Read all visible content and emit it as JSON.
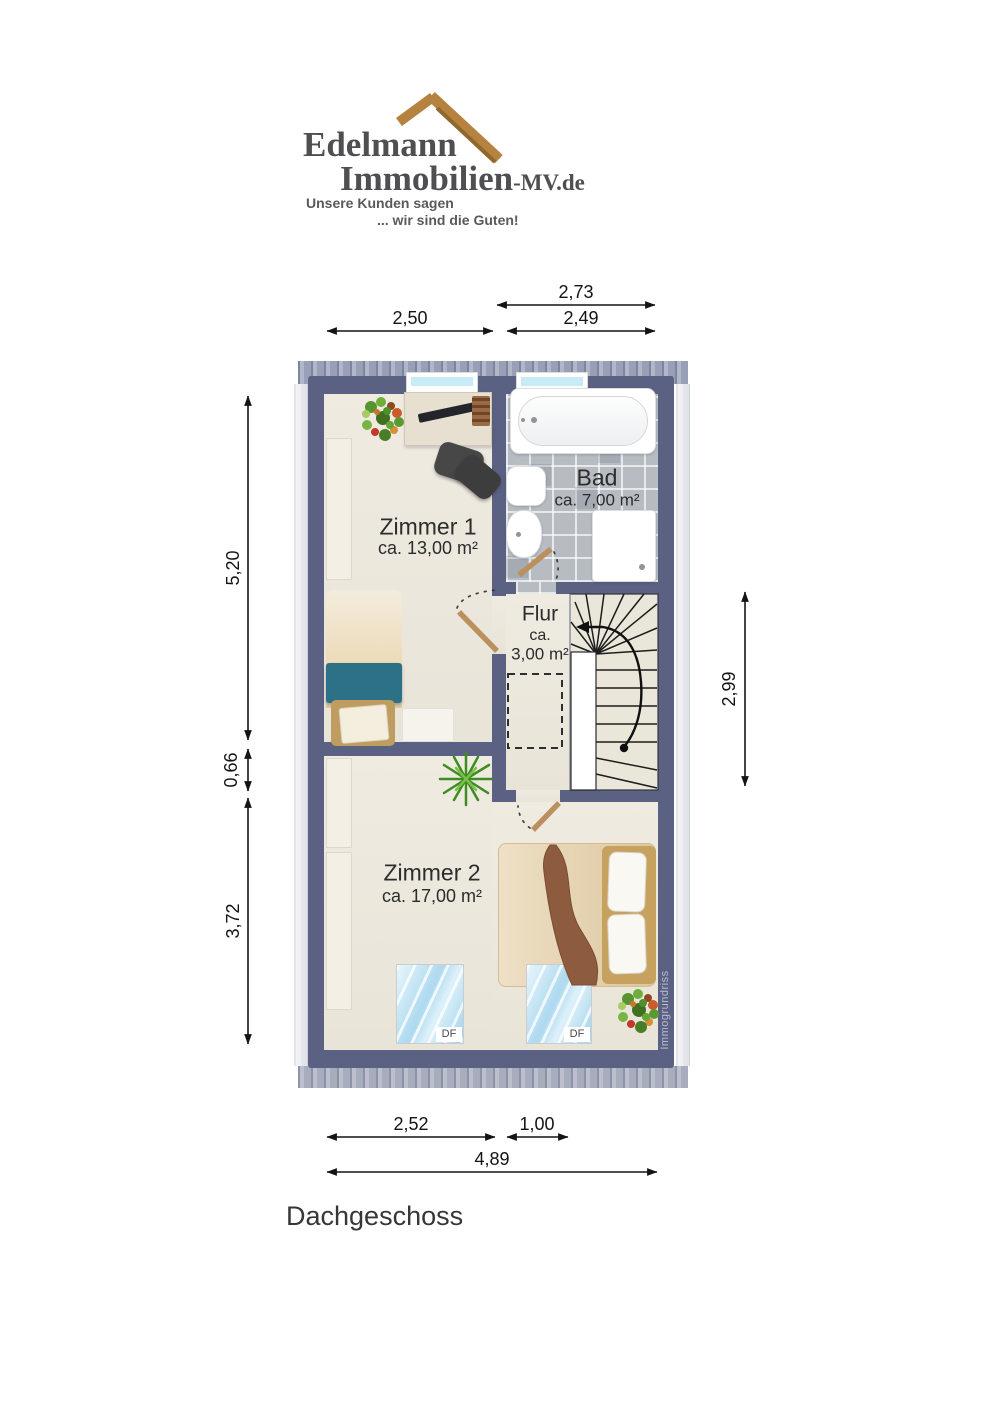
{
  "logo": {
    "brand_line1": "Edelmann",
    "brand_line2": "Immobilien",
    "brand_suffix": "-MV.de",
    "tagline_line1": "Unsere Kunden sagen",
    "tagline_line2": "... wir sind die Guten!"
  },
  "plan": {
    "floor_label": "Dachgeschoss",
    "watermark": "Immogrundriss",
    "skylight_label": "DF",
    "rooms": {
      "zimmer1": {
        "name": "Zimmer 1",
        "area": "ca. 13,00 m²"
      },
      "bad": {
        "name": "Bad",
        "area": "ca. 7,00 m²"
      },
      "flur": {
        "name": "Flur",
        "area_prefix": "ca.",
        "area_value": "3,00 m²"
      },
      "zimmer2": {
        "name": "Zimmer 2",
        "area": "ca. 17,00 m²"
      }
    },
    "dimensions": {
      "top_bad_width": "2,73",
      "top_zimmer1_width": "2,50",
      "top_bad_inner_width": "2,49",
      "left_zimmer1_height": "5,20",
      "left_offset": "0,66",
      "left_zimmer2_height": "3,72",
      "right_stair_height": "2,99",
      "bottom_zimmer2_width": "2,52",
      "bottom_stair_width": "1,00",
      "bottom_total_width": "4,89"
    }
  },
  "colors": {
    "wall": "#5b6183",
    "floor": "#ece8dd",
    "bath_tile": "#b7bcc2",
    "logo_roof": "#b5833f",
    "logo_text": "#4f4f52",
    "accent_teal": "#2d7186",
    "window_glass": "#c8ecf6",
    "bed_wood": "#8d5c3f"
  }
}
